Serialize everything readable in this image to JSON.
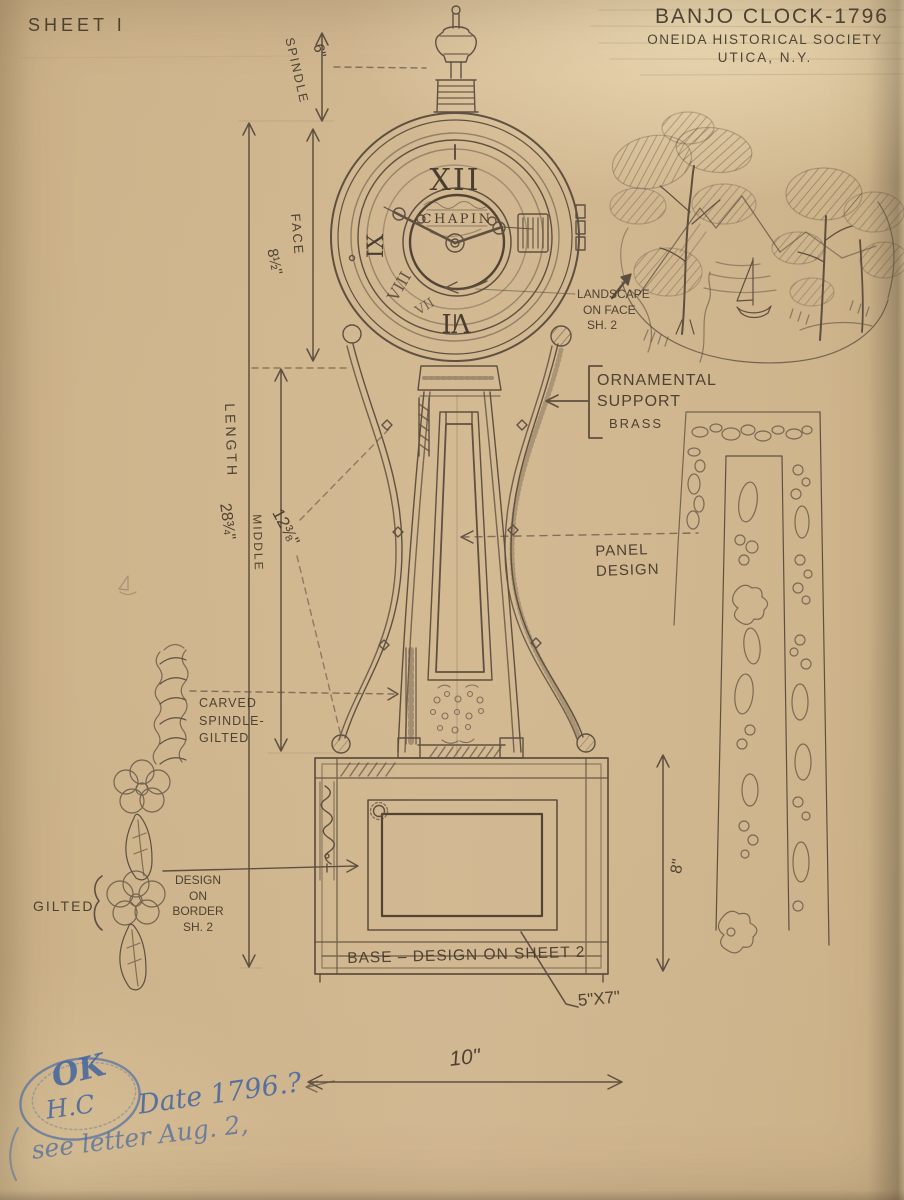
{
  "sheet": {
    "label": "SHEET I"
  },
  "title_block": {
    "title": "BANJO CLOCK-1796",
    "organization": "ONEIDA HISTORICAL SOCIETY",
    "location": "UTICA, N.Y."
  },
  "clock_face": {
    "maker": "CHAPIN",
    "numerals": {
      "twelve": "XII",
      "nine": "IX",
      "eight": "VIII",
      "seven": "VII",
      "six": "VI"
    }
  },
  "dimensions": {
    "spindle": {
      "label": "SPINDLE",
      "value": "6\""
    },
    "face": {
      "label": "FACE",
      "value": "8½\""
    },
    "length": {
      "label": "LENGTH",
      "value": "28¾\""
    },
    "middle": {
      "label": "MIDDLE",
      "value": "12⅜\""
    },
    "base_height": {
      "value": "8\""
    },
    "base_width": {
      "value": "10\""
    },
    "panel_opening": {
      "value": "5\"X7\""
    }
  },
  "notes": {
    "landscape": {
      "line1": "LANDSCAPE",
      "line2": "ON FACE",
      "line3": "SH. 2"
    },
    "ornamental_support": {
      "line1": "ORNAMENTAL",
      "line2": "SUPPORT",
      "line3": "BRASS"
    },
    "panel_design": {
      "line1": "PANEL",
      "line2": "DESIGN"
    },
    "carved_spindle": {
      "line1": "CARVED",
      "line2": "SPINDLE-",
      "line3": "GILTED"
    },
    "border_design": {
      "line1": "DESIGN",
      "line2": "ON",
      "line3": "BORDER",
      "line4": "SH. 2"
    },
    "gilted_label": "GILTED",
    "base_note": "BASE – DESIGN ON SHEET 2"
  },
  "handwritten_blue": {
    "stamp_top": "OK",
    "stamp_initials": "H.C",
    "date_note": "Date 1796.?",
    "letter_note": "see letter Aug. 2,"
  },
  "colors": {
    "paper": "#d2b892",
    "pencil": "#55483a",
    "blue_pencil": "#4c6da6"
  }
}
